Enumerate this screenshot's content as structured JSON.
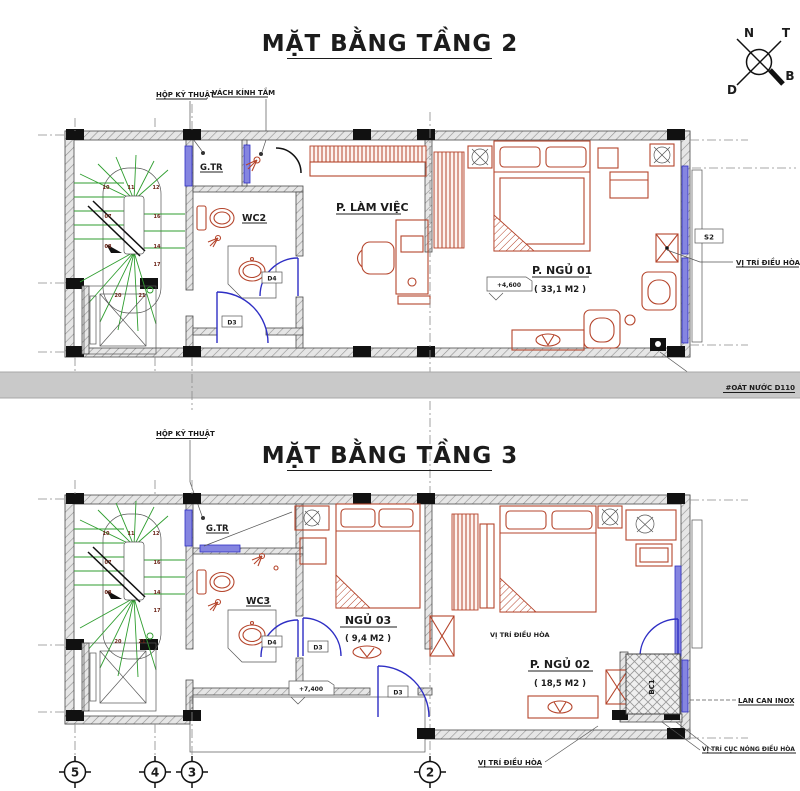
{
  "colors": {
    "furniture_red": "#b5452c",
    "door_blue": "#2e2ec4",
    "stair_green": "#2f9e2f",
    "band_gray": "#c9c9c9",
    "ink": "#1c1c1c"
  },
  "compass": {
    "n": "N",
    "t": "T",
    "d": "D",
    "b": "B"
  },
  "floor2": {
    "title": "MẶT BẰNG TẦNG 2",
    "callout_hop_ky_thuat": "HỘP KỸ THUẬT",
    "callout_vach_kinh_tam": "VÁCH KÍNH TẮM",
    "room_gtr": "G.TR",
    "room_wc": "WC2",
    "room_lam_viec": "P. LÀM VIỆC",
    "room_ngu01": "P. NGỦ 01",
    "room_ngu01_area": "( 33,1 M2 )",
    "level_mark": "+4,600",
    "window_tag": "S2",
    "ac_label": "VỊ TRÍ ĐIỀU HÒA",
    "door_d3": "D3",
    "door_d4": "D4"
  },
  "divider": {
    "drain_label": "#OÁT NƯỚC D110"
  },
  "floor3": {
    "title": "MẶT BẰNG TẦNG 3",
    "callout_hop_ky_thuat": "HỘP KỸ THUẬT",
    "room_gtr": "G.TR",
    "room_wc": "WC3",
    "room_ngu03": "NGỦ 03",
    "room_ngu03_area": "( 9,4 M2 )",
    "room_ngu02": "P. NGỦ 02",
    "room_ngu02_area": "( 18,5 M2 )",
    "level_mark": "+7,400",
    "balcony_tag": "BC1",
    "ac_label_mid": "VỊ TRÍ ĐIỀU HÒA",
    "ac_label_bottom": "VỊ TRÍ ĐIỀU HÒA",
    "ac_outdoor_label": "VỊ TRÍ CỤC NÓNG ĐIỀU HÒA",
    "railing_label": "LAN CAN INOX",
    "door_d3": "D3",
    "door_d3_front": "D3",
    "door_d4": "D4"
  },
  "grid": {
    "bubbles": [
      "5",
      "4",
      "3",
      "2"
    ]
  },
  "stairs": {
    "steps": [
      "10",
      "11",
      "12",
      "07",
      "16",
      "08",
      "14",
      "17",
      "20",
      "21"
    ]
  }
}
